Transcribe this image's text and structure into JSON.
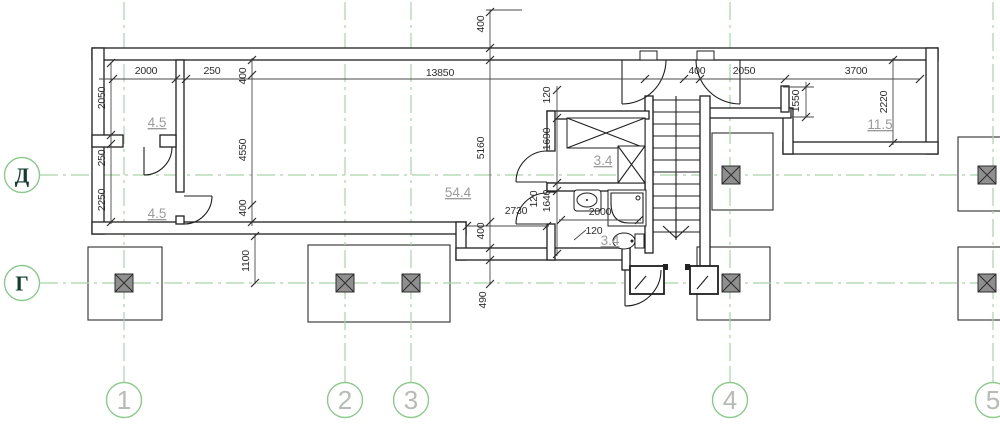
{
  "drawing": {
    "kind": "architectural-floor-plan",
    "colors": {
      "grid_green": "#a9d4a9",
      "axis_circle_green": "#8cc98c",
      "axis_letter_green": "#123d2c",
      "axis_number_gray": "#b5bbb5",
      "plan_line": "#1f1f1f",
      "dimension_text": "#2e2e2e",
      "room_label_gray": "#9b9b9b",
      "column_fill": "#8f8f8f"
    },
    "axis_rows": [
      {
        "label": "Д",
        "y": 175
      },
      {
        "label": "Г",
        "y": 283
      }
    ],
    "axis_cols": [
      {
        "label": "1",
        "x": 124
      },
      {
        "label": "2",
        "x": 345
      },
      {
        "label": "3",
        "x": 411
      },
      {
        "label": "4",
        "x": 730
      },
      {
        "label": "5",
        "x": 993
      }
    ],
    "room_labels": [
      {
        "t": "4.5",
        "x": 157,
        "y": 127
      },
      {
        "t": "4.5",
        "x": 157,
        "y": 218
      },
      {
        "t": "54.4",
        "x": 458,
        "y": 197
      },
      {
        "t": "3.4",
        "x": 603,
        "y": 165
      },
      {
        "t": "3.4",
        "x": 610,
        "y": 245
      },
      {
        "t": "11.5",
        "x": 880,
        "y": 129
      }
    ],
    "dimensions_horizontal": [
      {
        "t": "2000",
        "x": 146,
        "y": 74
      },
      {
        "t": "250",
        "x": 212,
        "y": 74
      },
      {
        "t": "13850",
        "x": 440,
        "y": 76
      },
      {
        "t": "400",
        "x": 697,
        "y": 74
      },
      {
        "t": "2050",
        "x": 744,
        "y": 74
      },
      {
        "t": "3700",
        "x": 856,
        "y": 74
      },
      {
        "t": "2730",
        "x": 516,
        "y": 214
      },
      {
        "t": "2000",
        "x": 600,
        "y": 215
      },
      {
        "t": "120",
        "x": 594,
        "y": 234
      }
    ],
    "dimensions_vertical": [
      {
        "t": "400",
        "x": 484,
        "y": 24
      },
      {
        "t": "2050",
        "x": 105,
        "y": 98
      },
      {
        "t": "250",
        "x": 105,
        "y": 158
      },
      {
        "t": "2250",
        "x": 105,
        "y": 200
      },
      {
        "t": "400",
        "x": 246,
        "y": 76
      },
      {
        "t": "4550",
        "x": 246,
        "y": 150
      },
      {
        "t": "400",
        "x": 246,
        "y": 208
      },
      {
        "t": "1100",
        "x": 249,
        "y": 261
      },
      {
        "t": "5160",
        "x": 484,
        "y": 148
      },
      {
        "t": "400",
        "x": 484,
        "y": 231
      },
      {
        "t": "490",
        "x": 486,
        "y": 300
      },
      {
        "t": "120",
        "x": 550,
        "y": 95
      },
      {
        "t": "1690",
        "x": 550,
        "y": 139
      },
      {
        "t": "120",
        "x": 537,
        "y": 199
      },
      {
        "t": "1640",
        "x": 550,
        "y": 201
      },
      {
        "t": "1550",
        "x": 799,
        "y": 101
      },
      {
        "t": "2220",
        "x": 887,
        "y": 102
      }
    ]
  }
}
